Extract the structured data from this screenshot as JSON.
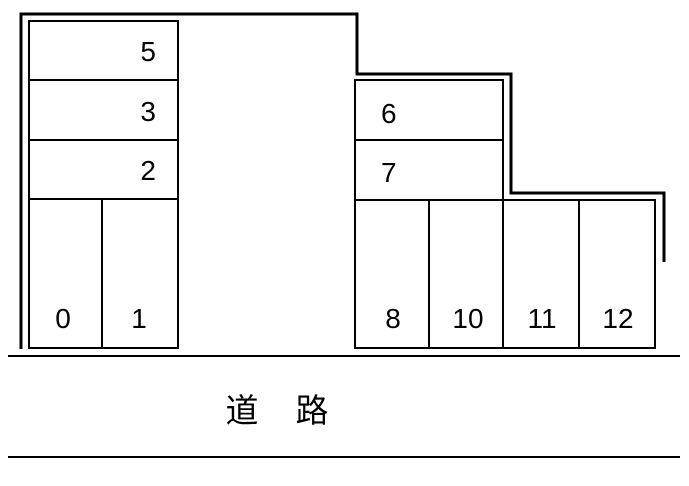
{
  "diagram": {
    "type": "parking-lot-layout",
    "road_label": "道　路",
    "left_block": {
      "rows": [
        {
          "label": "5"
        },
        {
          "label": "3"
        },
        {
          "label": "2"
        }
      ],
      "stalls": [
        {
          "label": "0"
        },
        {
          "label": "1"
        }
      ]
    },
    "right_block": {
      "rows": [
        {
          "label": "6"
        },
        {
          "label": "7"
        }
      ],
      "stalls": [
        {
          "label": "8"
        },
        {
          "label": "10"
        },
        {
          "label": "11"
        },
        {
          "label": "12"
        }
      ]
    },
    "colors": {
      "line": "#000000",
      "background": "#ffffff"
    }
  }
}
